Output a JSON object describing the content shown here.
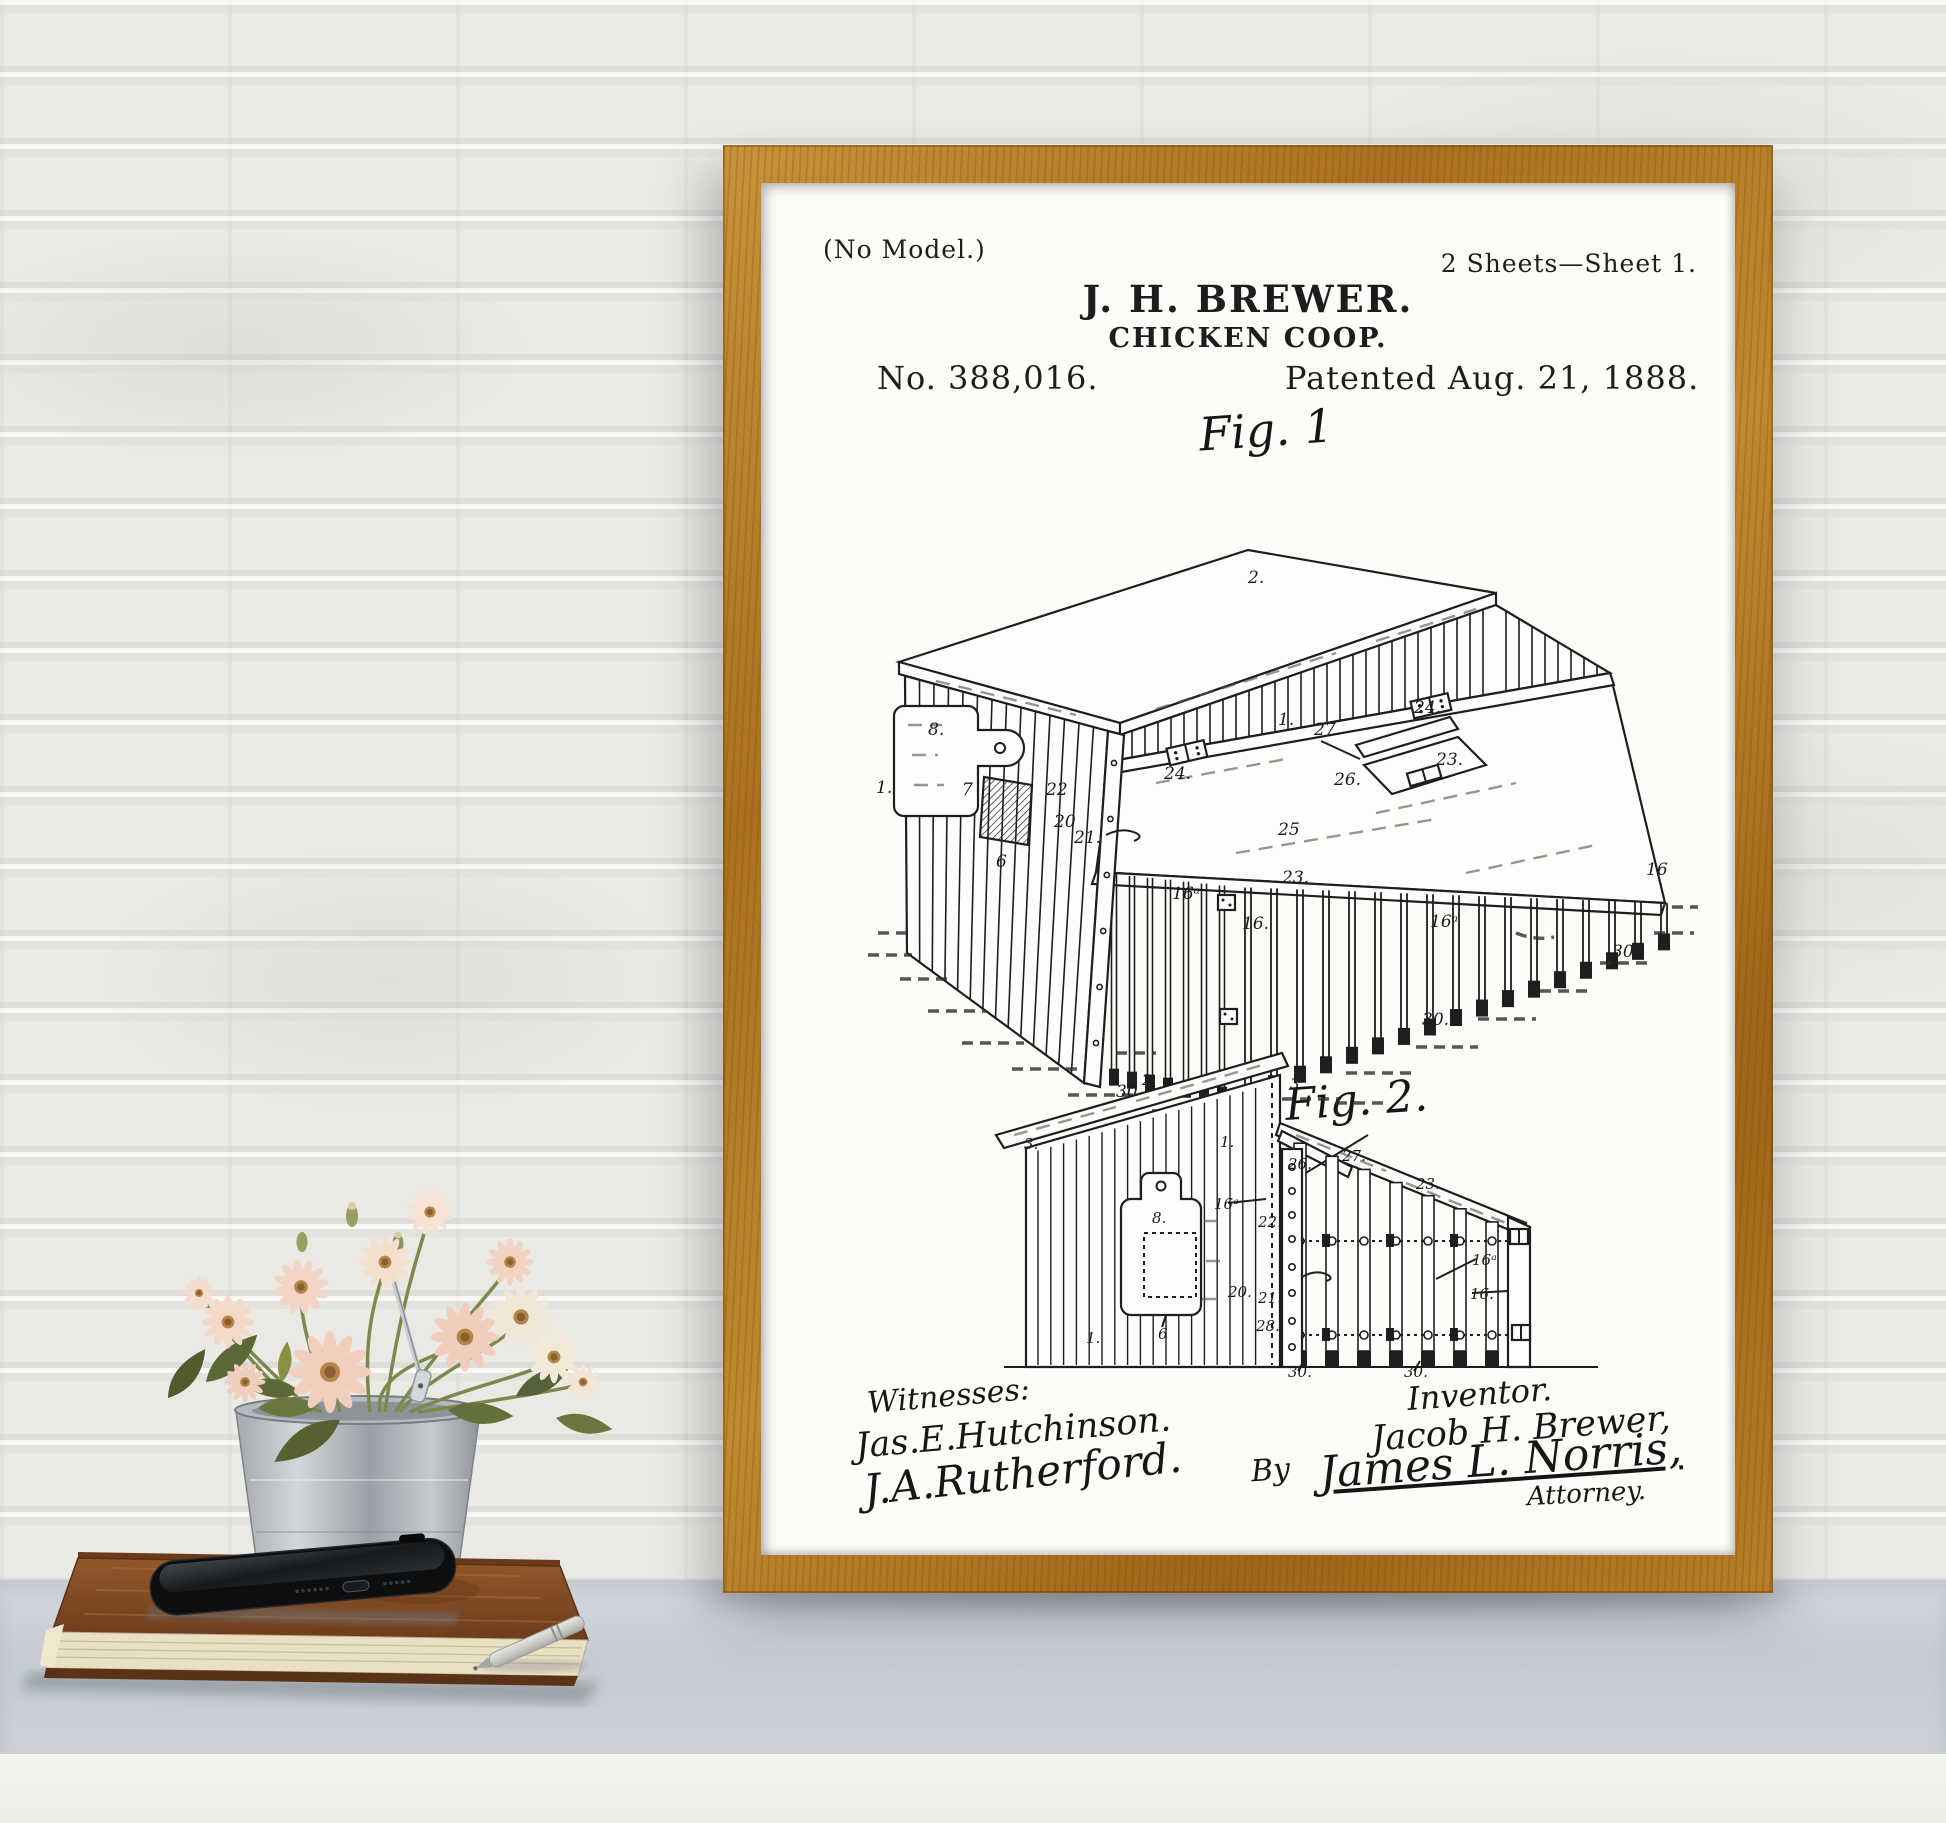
{
  "scene": {
    "colors": {
      "frame_wood": "#b07c26",
      "wall": "#ebe9e4",
      "table_top": "#c9ced6",
      "table_front": "#f3f2ec",
      "paper": "#fcfcf9",
      "ink": "#1d1d1d",
      "flower_pink": "#f2d0bf",
      "flower_cream": "#f0e7d7",
      "bucket_zinc": "#b9bfc4",
      "book_leather": "#8a5127"
    }
  },
  "patent": {
    "header": {
      "no_model": "(No Model.)",
      "sheet_info": "2 Sheets—Sheet 1.",
      "inventor": "J. H. BREWER.",
      "title": "CHICKEN COOP.",
      "number": "No. 388,016.",
      "date": "Patented Aug. 21, 1888."
    },
    "fig1": {
      "caption": "Fig. 1",
      "labels": [
        {
          "text": "2.",
          "x": 432,
          "y": 120
        },
        {
          "text": "1.",
          "x": 462,
          "y": 262
        },
        {
          "text": "1.",
          "x": 60,
          "y": 330
        },
        {
          "text": "8.",
          "x": 112,
          "y": 272
        },
        {
          "text": "7",
          "x": 146,
          "y": 332
        },
        {
          "text": "6",
          "x": 180,
          "y": 404
        },
        {
          "text": "22",
          "x": 230,
          "y": 332
        },
        {
          "text": "20",
          "x": 238,
          "y": 364
        },
        {
          "text": "21.",
          "x": 258,
          "y": 380
        },
        {
          "text": "24.",
          "x": 348,
          "y": 316
        },
        {
          "text": "24.",
          "x": 598,
          "y": 250
        },
        {
          "text": "27.",
          "x": 498,
          "y": 272
        },
        {
          "text": "26.",
          "x": 518,
          "y": 322
        },
        {
          "text": "25",
          "x": 462,
          "y": 372
        },
        {
          "text": "23.",
          "x": 620,
          "y": 302
        },
        {
          "text": "23.",
          "x": 466,
          "y": 420
        },
        {
          "text": "16ᵃ",
          "x": 356,
          "y": 436
        },
        {
          "text": "16.",
          "x": 426,
          "y": 466
        },
        {
          "text": "16ᵃ",
          "x": 614,
          "y": 464
        },
        {
          "text": "16",
          "x": 830,
          "y": 412
        },
        {
          "text": "30.",
          "x": 300,
          "y": 634
        },
        {
          "text": "30.",
          "x": 606,
          "y": 562
        },
        {
          "text": "30.",
          "x": 796,
          "y": 494
        }
      ]
    },
    "fig2": {
      "caption": "Fig. 2.",
      "labels": [
        {
          "text": "3.",
          "x": 58,
          "y": 118
        },
        {
          "text": "2.",
          "x": 176,
          "y": 54
        },
        {
          "text": "3.",
          "x": 324,
          "y": 58
        },
        {
          "text": "1.",
          "x": 254,
          "y": 116
        },
        {
          "text": "1.",
          "x": 120,
          "y": 312
        },
        {
          "text": "8.",
          "x": 186,
          "y": 192
        },
        {
          "text": "6",
          "x": 192,
          "y": 308
        },
        {
          "text": "16ᵃ",
          "x": 248,
          "y": 178
        },
        {
          "text": "22.",
          "x": 292,
          "y": 196
        },
        {
          "text": "20.",
          "x": 262,
          "y": 266
        },
        {
          "text": "21.",
          "x": 292,
          "y": 272
        },
        {
          "text": "28.",
          "x": 290,
          "y": 300
        },
        {
          "text": "26.",
          "x": 322,
          "y": 138
        },
        {
          "text": "27.",
          "x": 376,
          "y": 130
        },
        {
          "text": "23.",
          "x": 450,
          "y": 158
        },
        {
          "text": "16ᵃ",
          "x": 506,
          "y": 234
        },
        {
          "text": "16.",
          "x": 504,
          "y": 268
        },
        {
          "text": "30.",
          "x": 322,
          "y": 346
        },
        {
          "text": "30.",
          "x": 438,
          "y": 346
        }
      ]
    },
    "signatures": {
      "witnesses_heading": "Witnesses:",
      "witness_1": "Jas.E.Hutchinson.",
      "witness_2": "J.A.Rutherford.",
      "inventor_heading": "Inventor.",
      "inventor_name": "Jacob H. Brewer,",
      "by": "By",
      "attorney_name": "James L. Norris,",
      "attorney_title": "Attorney."
    }
  }
}
